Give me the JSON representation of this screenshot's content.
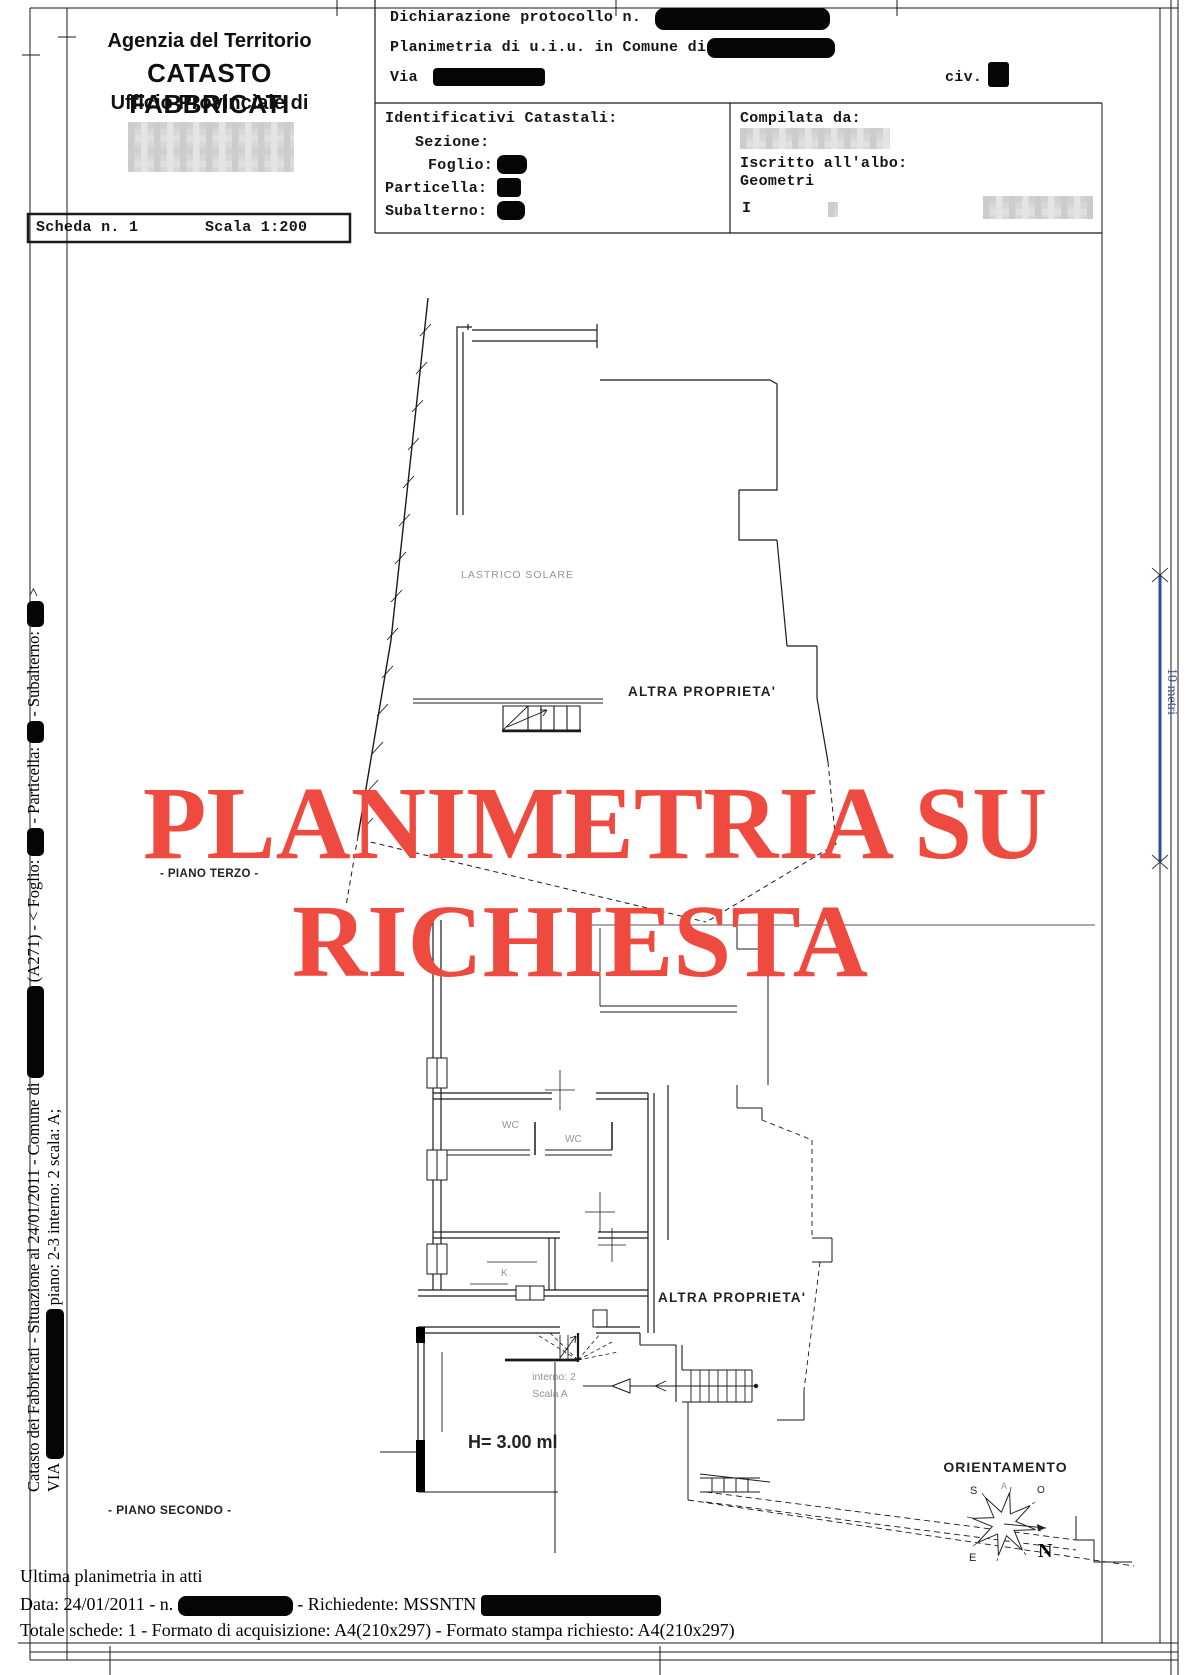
{
  "header": {
    "agency": "Agenzia del Territorio",
    "catasto": "CATASTO FABBRICATI",
    "ufficio": "Ufficio Provinciale di",
    "dichiarazione": "Dichiarazione protocollo n.",
    "planimetria": "Planimetria di u.i.u. in Comune di",
    "via": "Via",
    "civ": "civ.",
    "identificativi": "Identificativi Catastali:",
    "sezione": "Sezione:",
    "foglio": "Foglio:",
    "particella": "Particella:",
    "subalterno": "Subalterno:",
    "compilata": "Compilata da:",
    "iscritto_albo": "Iscritto all'albo:",
    "albo": "Geometri",
    "firmatario": "I"
  },
  "scheda": {
    "numero": "Scheda n. 1",
    "scala": "Scala 1:200"
  },
  "watermark": {
    "line1": "PLANIMETRIA SU",
    "line2": "RICHIESTA",
    "color": "#ee4a3f"
  },
  "plan": {
    "lastrico_solare": "LASTRICO SOLARE",
    "altra_proprieta_1": "ALTRA PROPRIETA'",
    "altra_proprieta_2": "ALTRA PROPRIETA'",
    "piano_terzo": "- PIANO TERZO -",
    "piano_secondo": "- PIANO SECONDO -",
    "wc_1": "WC",
    "wc_2": "WC",
    "kitchen": "K",
    "interno": "interno: 2",
    "scala_int": "Scala A",
    "altezza": "H= 3.00 ml",
    "orientamento": "ORIENTAMENTO",
    "compass_n": "N",
    "compass_s": "S",
    "compass_e": "E",
    "compass_o": "O",
    "compass_a": "A",
    "scalebar_label": "10 metri",
    "scalebar_color": "#2e4f96"
  },
  "sidebar": {
    "seg1": "Catasto dei Fabbricati - Situazione al 24/01/2011 - Comune di",
    "seg2": "(A271) - < Foglio:",
    "seg3": "- Particella:",
    "seg4": "- Subalterno:",
    "seg5": ">",
    "via": "VIA",
    "unit": "piano: 2-3 interno: 2 scala: A;"
  },
  "footer": {
    "ultima": "Ultima planimetria in atti",
    "data_prefix": "Data: 24/01/2011 - n.",
    "richiedente": "- Richiedente: MSSNTN",
    "totale": "Totale schede: 1 - Formato di acquisizione: A4(210x297)  - Formato stampa richiesto: A4(210x297)"
  }
}
